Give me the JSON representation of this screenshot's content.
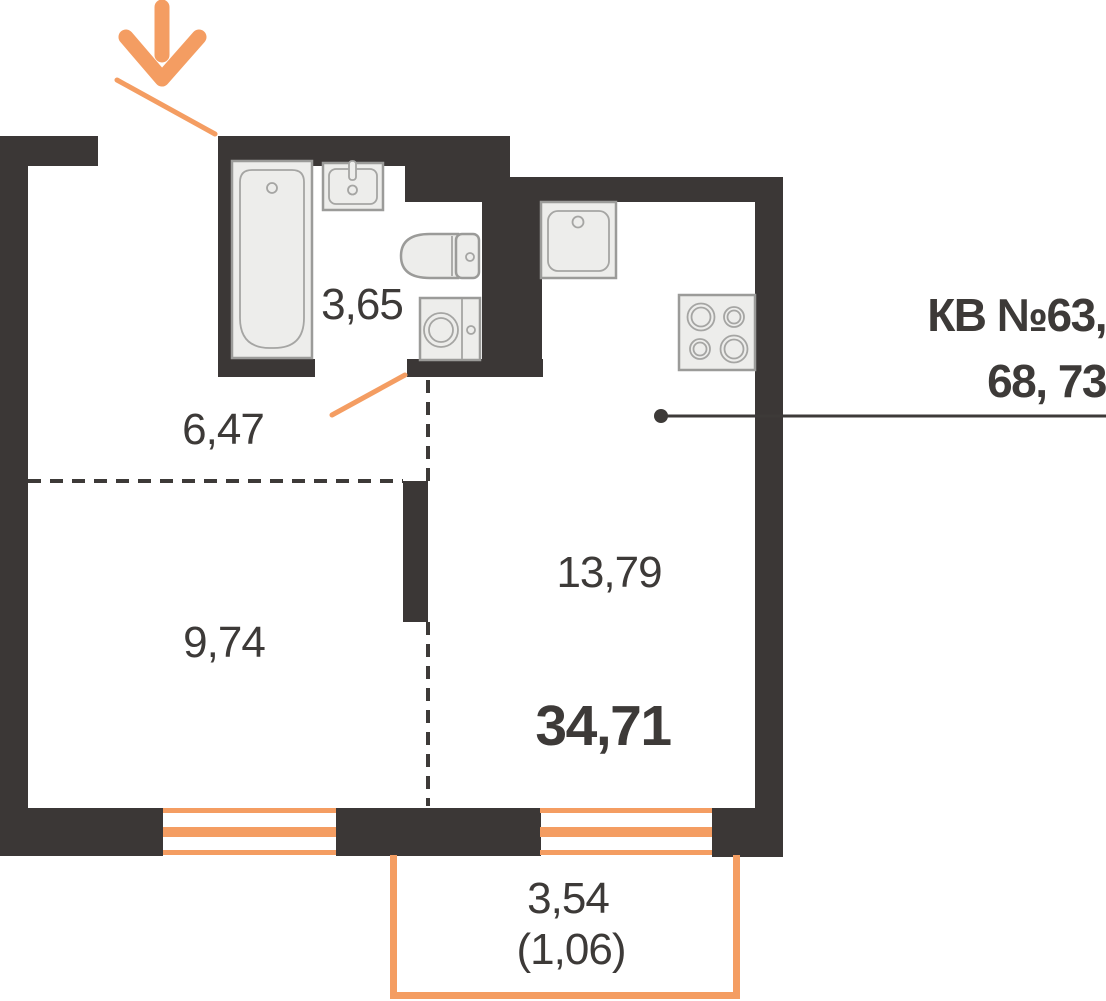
{
  "unit_label": {
    "line1": "КВ №63,",
    "line2": "68, 73"
  },
  "rooms": {
    "bathroom": {
      "area": "3,65"
    },
    "hallway": {
      "area": "6,47"
    },
    "bedroom": {
      "area": "9,74"
    },
    "kitchen_living": {
      "area": "13,79"
    }
  },
  "total_area": "34,71",
  "balcony": {
    "area": "3,54",
    "counted_area": "(1,06)"
  },
  "icons": {
    "entrance_arrow": "down-arrow",
    "fixtures": [
      "bathtub",
      "bathroom-sink",
      "toilet",
      "washing-machine",
      "kitchen-sink",
      "cooktop"
    ]
  },
  "colors": {
    "wall": "#3b3736",
    "accent": "#f49d62",
    "ink": "#3d3a38",
    "fixture_fill": "#ededeb",
    "fixture_stroke": "#9b9b99",
    "fixture_detail": "#a5a5a3"
  }
}
